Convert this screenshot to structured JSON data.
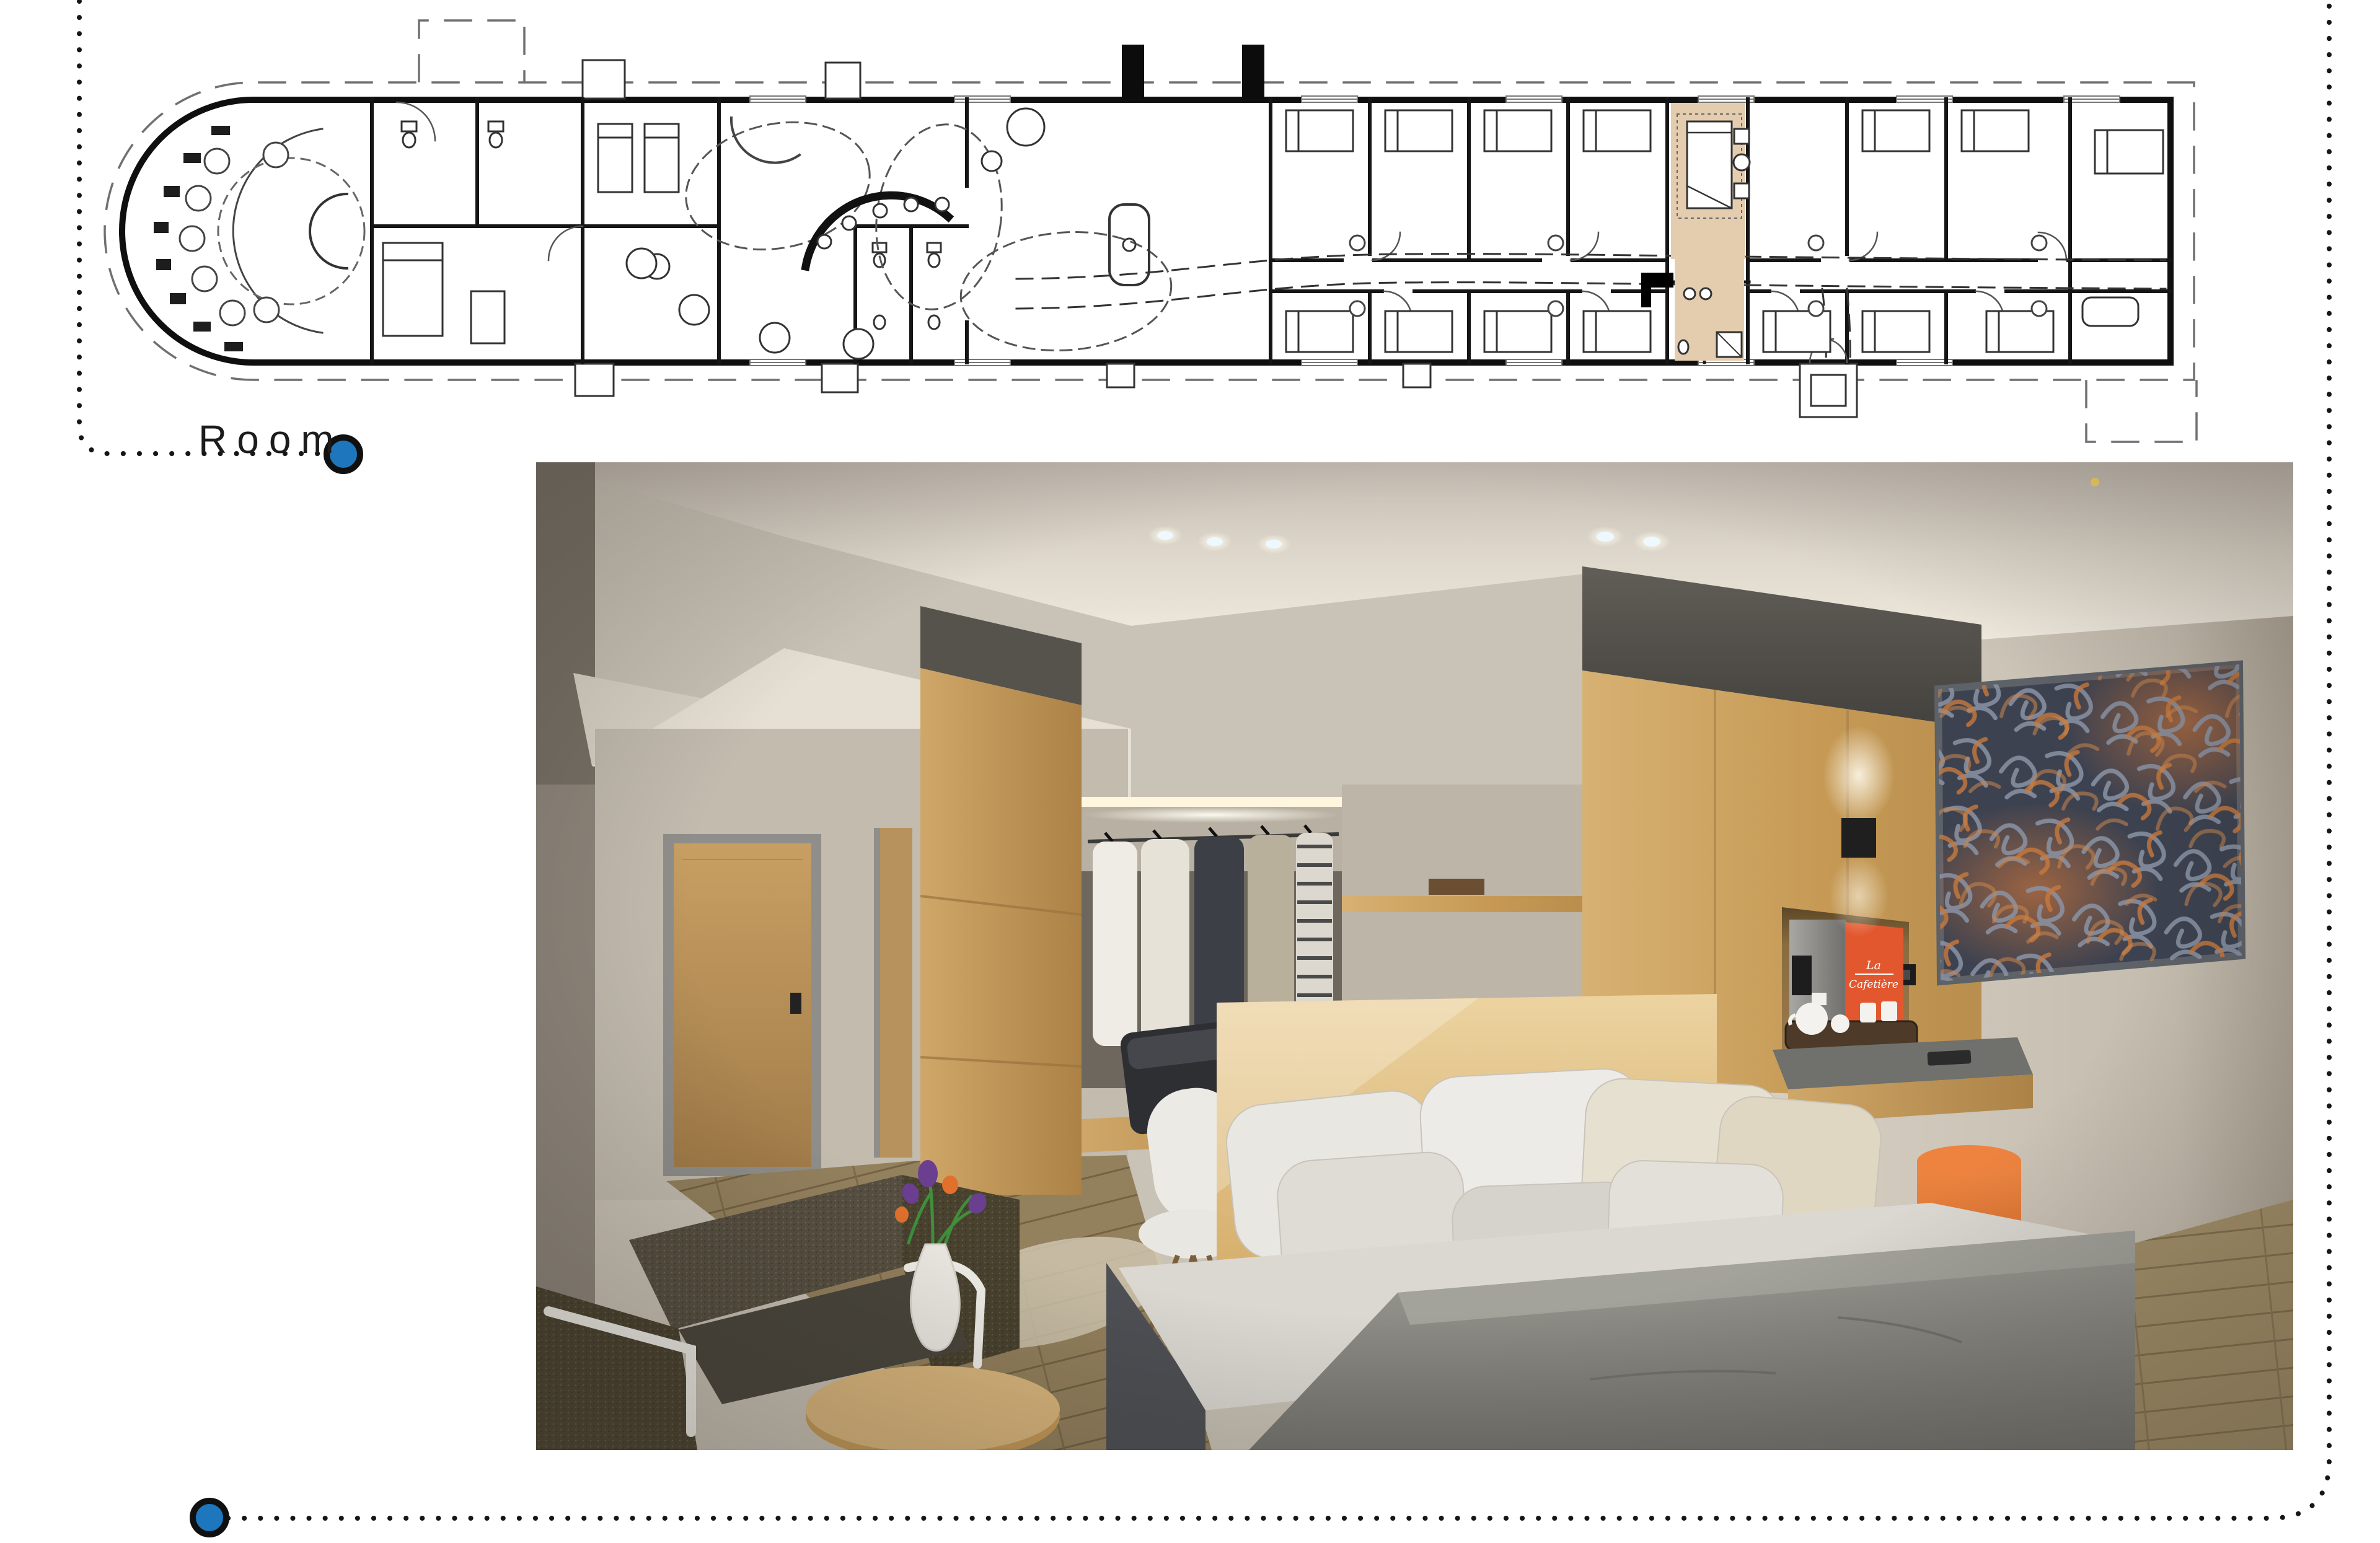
{
  "floor_plan": {
    "label": "Room",
    "marker_icon": "filled-circle",
    "colors": {
      "marker_blue": "#1E76BC",
      "marker_ring": "#101010",
      "highlight_beige": "#E4CDAF",
      "walls": "#111111",
      "dashed_outline": "#707070",
      "dotted_flow": "#161616"
    }
  },
  "render": {
    "coffee_machine": {
      "brand": "La Cafetière",
      "brand_lines": [
        "La",
        "Cafetière"
      ]
    },
    "colors": {
      "accent_orange": "#E2572E",
      "stool_orange": "#EE8340",
      "wood": "#D2A566",
      "wall": "#C9C2B6",
      "dark_bulkhead": "#55524D",
      "blanket_gray": "#8F8E88",
      "art_orange": "#D37A3E",
      "art_blue_gray": "#8A93A5"
    }
  }
}
